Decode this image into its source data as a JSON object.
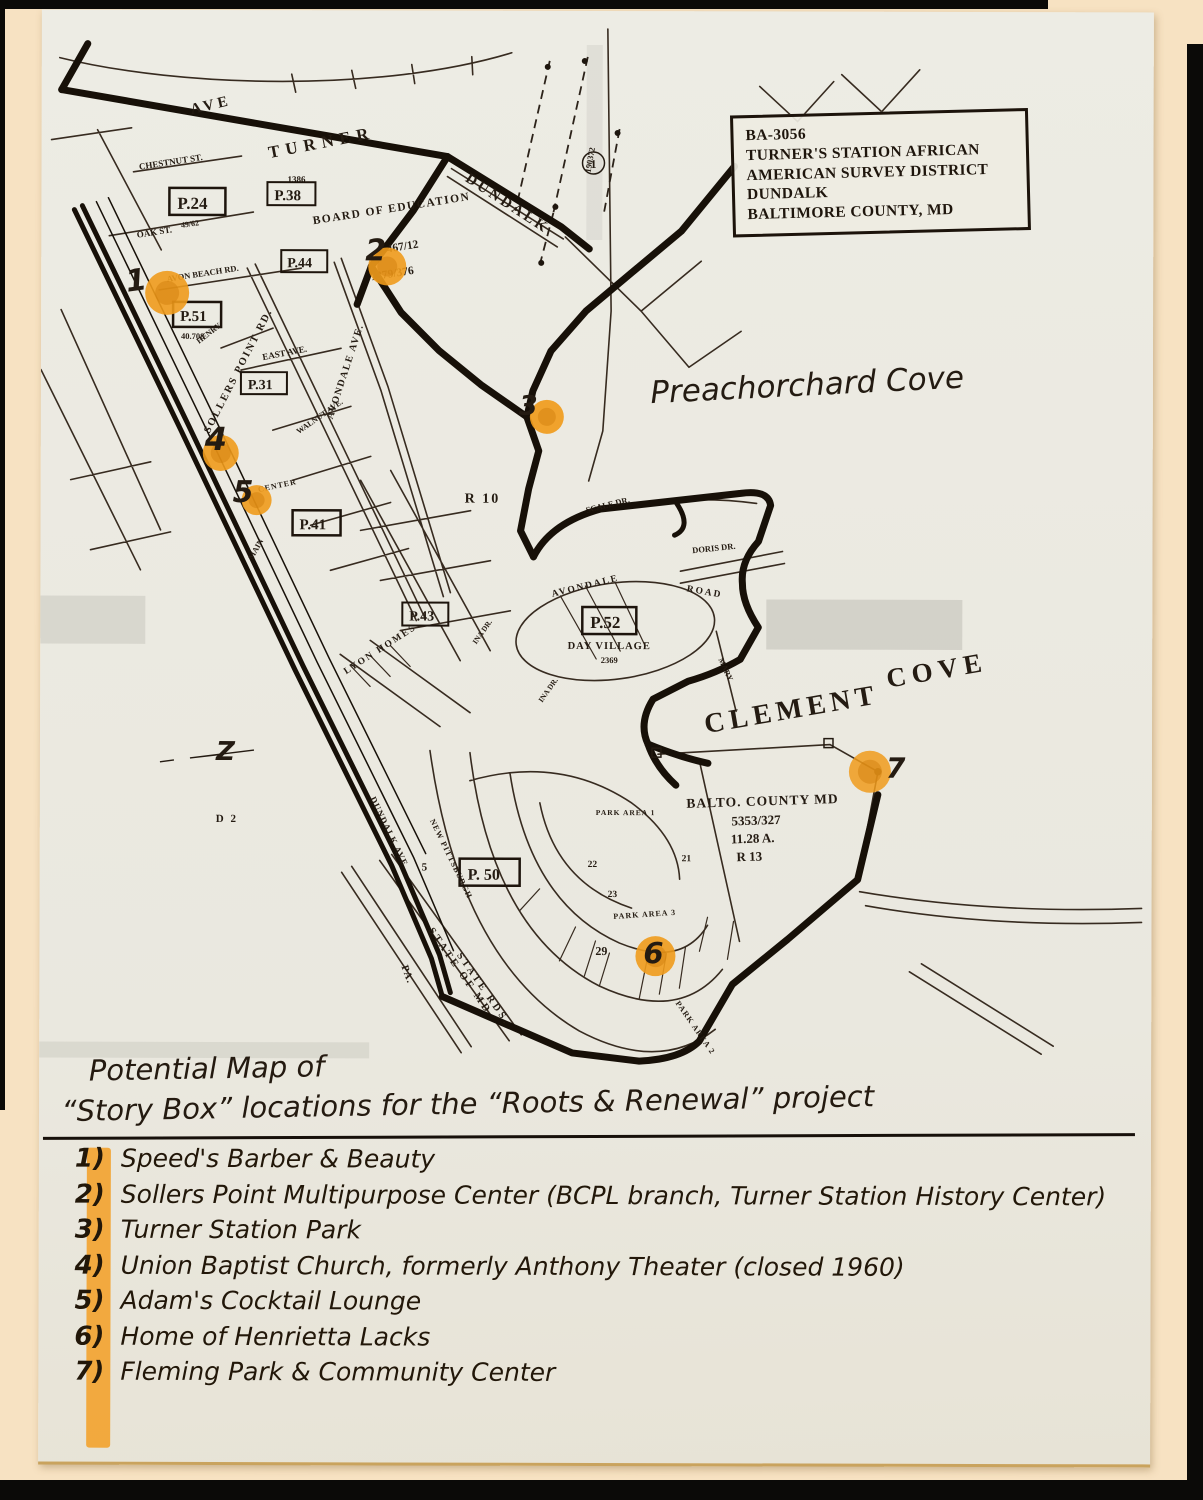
{
  "page": {
    "title_line1": "Potential Map of",
    "title_line2": "“Story Box” locations for the “Roots & Renewal” project"
  },
  "survey_box": {
    "lines": [
      "BA-3056",
      "TURNER'S STATION AFRICAN",
      "AMERICAN SURVEY DISTRICT",
      "DUNDALK",
      "BALTIMORE COUNTY, MD"
    ]
  },
  "locations": [
    {
      "num": "1)",
      "label": "Speed's Barber & Beauty"
    },
    {
      "num": "2)",
      "label": "Sollers Point Multipurpose Center (BCPL branch, Turner Station History Center)"
    },
    {
      "num": "3)",
      "label": "Turner Station Park"
    },
    {
      "num": "4)",
      "label": "Union Baptist Church, formerly Anthony Theater (closed 1960)"
    },
    {
      "num": "5)",
      "label": "Adam's Cocktail Lounge"
    },
    {
      "num": "6)",
      "label": "Home of Henrietta Lacks"
    },
    {
      "num": "7)",
      "label": "Fleming Park & Community Center"
    }
  ],
  "map": {
    "handwritten": {
      "preachorchard": "Preachorchard Cove",
      "z_mark": "Z"
    },
    "markers": [
      "1",
      "2",
      "3",
      "4",
      "5",
      "6",
      "7"
    ],
    "labels": {
      "ave": "AVE",
      "turner": "TURNER",
      "dundalk_st": "DUNDALK",
      "n1386": "1386",
      "chestnut": "CHESTNUT ST.",
      "oak": "OAK ST.",
      "p24": "P.24",
      "n4962": "49/62",
      "p38": "P.38",
      "p44": "P.44",
      "board1": "BOARD OF EDUCATION",
      "board2": "467/12",
      "board3": "1379/376",
      "n190372": "190372",
      "circ1": "1",
      "avon_beach": "AVON BEACH RD.",
      "p51": "P.51",
      "n40708": "40.708",
      "henry": "HENRY",
      "sollers": "SOLLERS POINT RD.",
      "avondale_ave": "AVONDALE AVE.",
      "east_ave": "EAST AVE.",
      "p31": "P.31",
      "walnut": "WALNUT AVE.",
      "center_st": "CENTER",
      "p41": "P.41",
      "main_st": "MAIN",
      "r10": "R 10",
      "scale_dr": "SCALE DR.",
      "doris_dr": "DORIS DR.",
      "p43": "P.43",
      "lyon": "LYON HOMES",
      "avondale_rd": "AVONDALE",
      "road_lbl": "ROAD",
      "p52": "P.52",
      "day_village": "DAY VILLAGE",
      "n2369": "2369",
      "mary": "MARY",
      "ina": "INA DR.",
      "clement": "CLEMENT",
      "cove": "COVE",
      "balto1": "BALTO. COUNTY MD",
      "balto2": "5353/327",
      "balto3": "11.28 A.",
      "balto4": "R 13",
      "d2_lbl": "D 2",
      "dundalk_ave": "DUNDALK AVE.",
      "new_pitt": "NEW PITTSBURGH",
      "n5": "5",
      "p50": "P. 50",
      "n22": "22",
      "n23": "23",
      "n21": "21",
      "n29": "29",
      "park1": "PARK AREA 1",
      "park3": "PARK AREA 3",
      "park2": "PARK AREA 2",
      "state1": "STATE OF MD",
      "state2": "STATE RDS.",
      "pa_lbl": "PA."
    },
    "colors": {
      "marker_orange": "#f09b1c",
      "highlighter_orange": "#f2a029",
      "ink": "#17100a",
      "paper": "#eae8df",
      "backdrop": "#f7e2c2"
    }
  }
}
